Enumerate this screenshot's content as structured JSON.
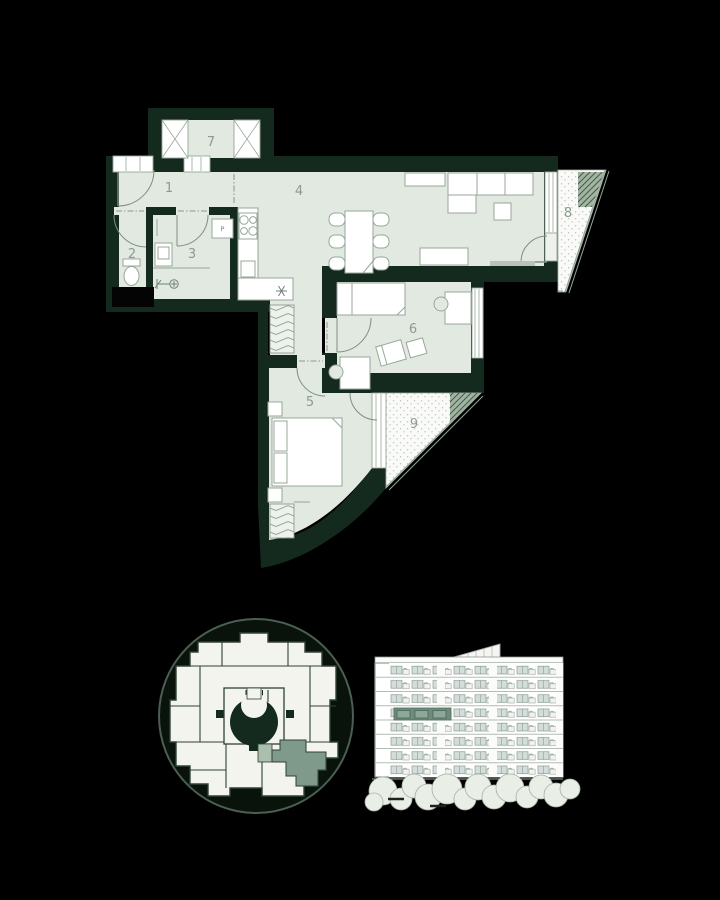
{
  "floor_plan": {
    "room_labels": [
      "1",
      "2",
      "3",
      "4",
      "5",
      "6",
      "7",
      "8",
      "9"
    ],
    "washing_machine_label": "P"
  },
  "palette": {
    "background": "#000000",
    "wall": "#152a1e",
    "room_fill": "#e2e9e0",
    "furniture_line": "#97a79a",
    "label_color": "#8b9c8e",
    "balcony_fill": "#fafaf8",
    "accent_green": "#7f998a",
    "accent_green_light": "#aabfae",
    "elevation_highlight": "#6e8c7c"
  },
  "minimap": {
    "highlighted_unit_color": "#7f998a"
  },
  "elevation": {
    "floor_count": 8,
    "highlight_color": "#6e8c7c"
  }
}
